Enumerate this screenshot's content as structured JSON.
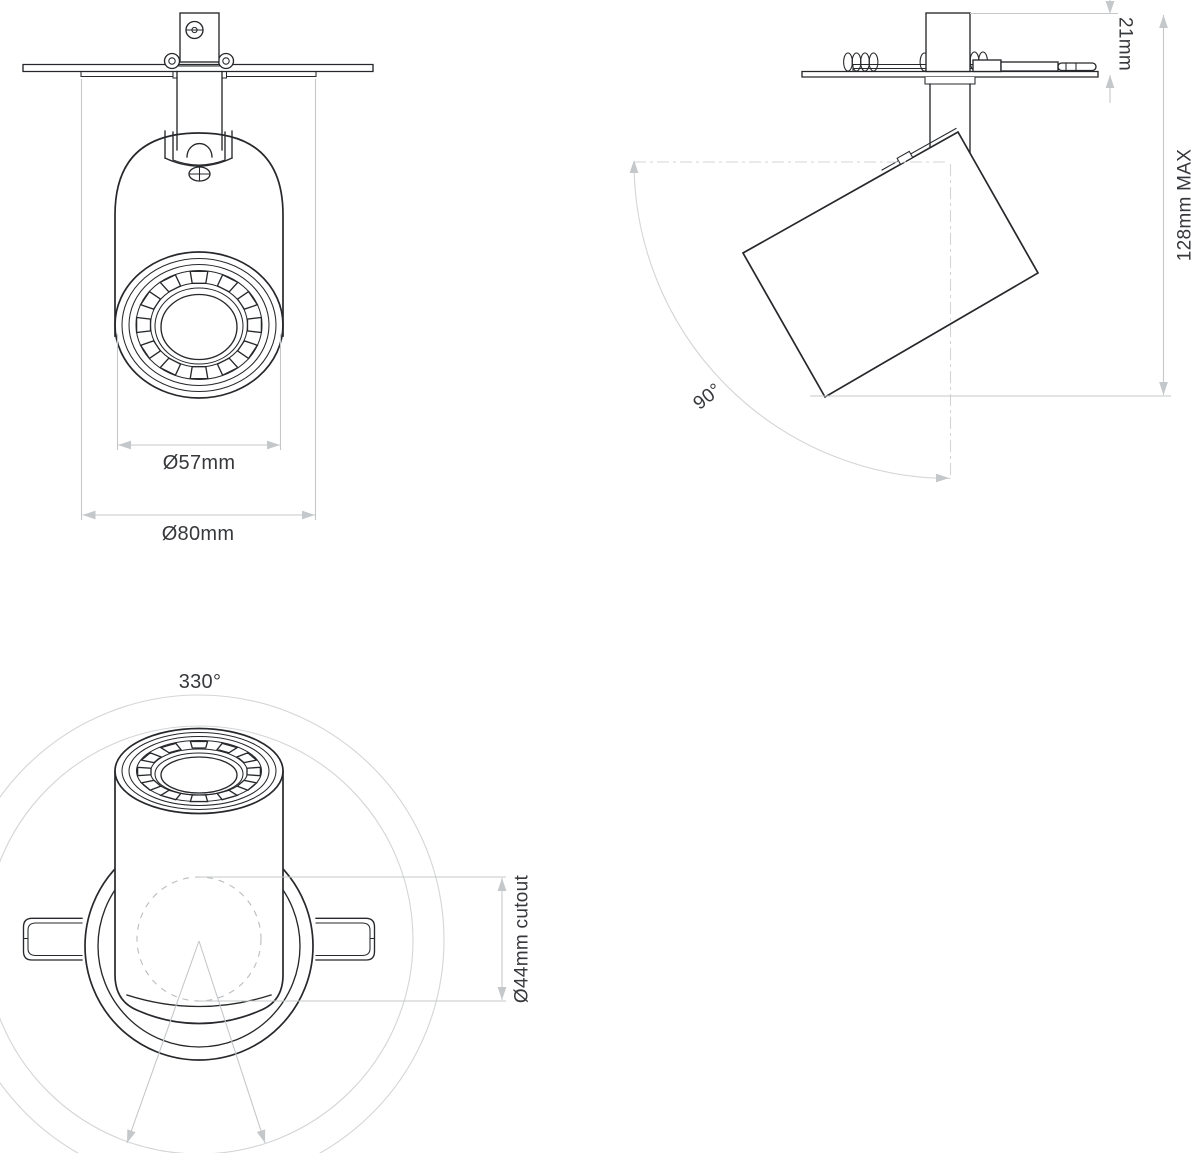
{
  "labels": {
    "lens_diameter": "Ø57mm",
    "bezel_diameter": "Ø80mm",
    "recess_depth": "21mm",
    "max_projection": "128mm MAX",
    "tilt_angle": "90°",
    "rotation_angle": "330°",
    "cutout_diameter": "Ø44mm cutout"
  },
  "colors": {
    "outline": "#26282b",
    "dimension": "#c5c8ca",
    "reference": "#d3d5d7",
    "text": "#36383b",
    "background": "#ffffff"
  }
}
